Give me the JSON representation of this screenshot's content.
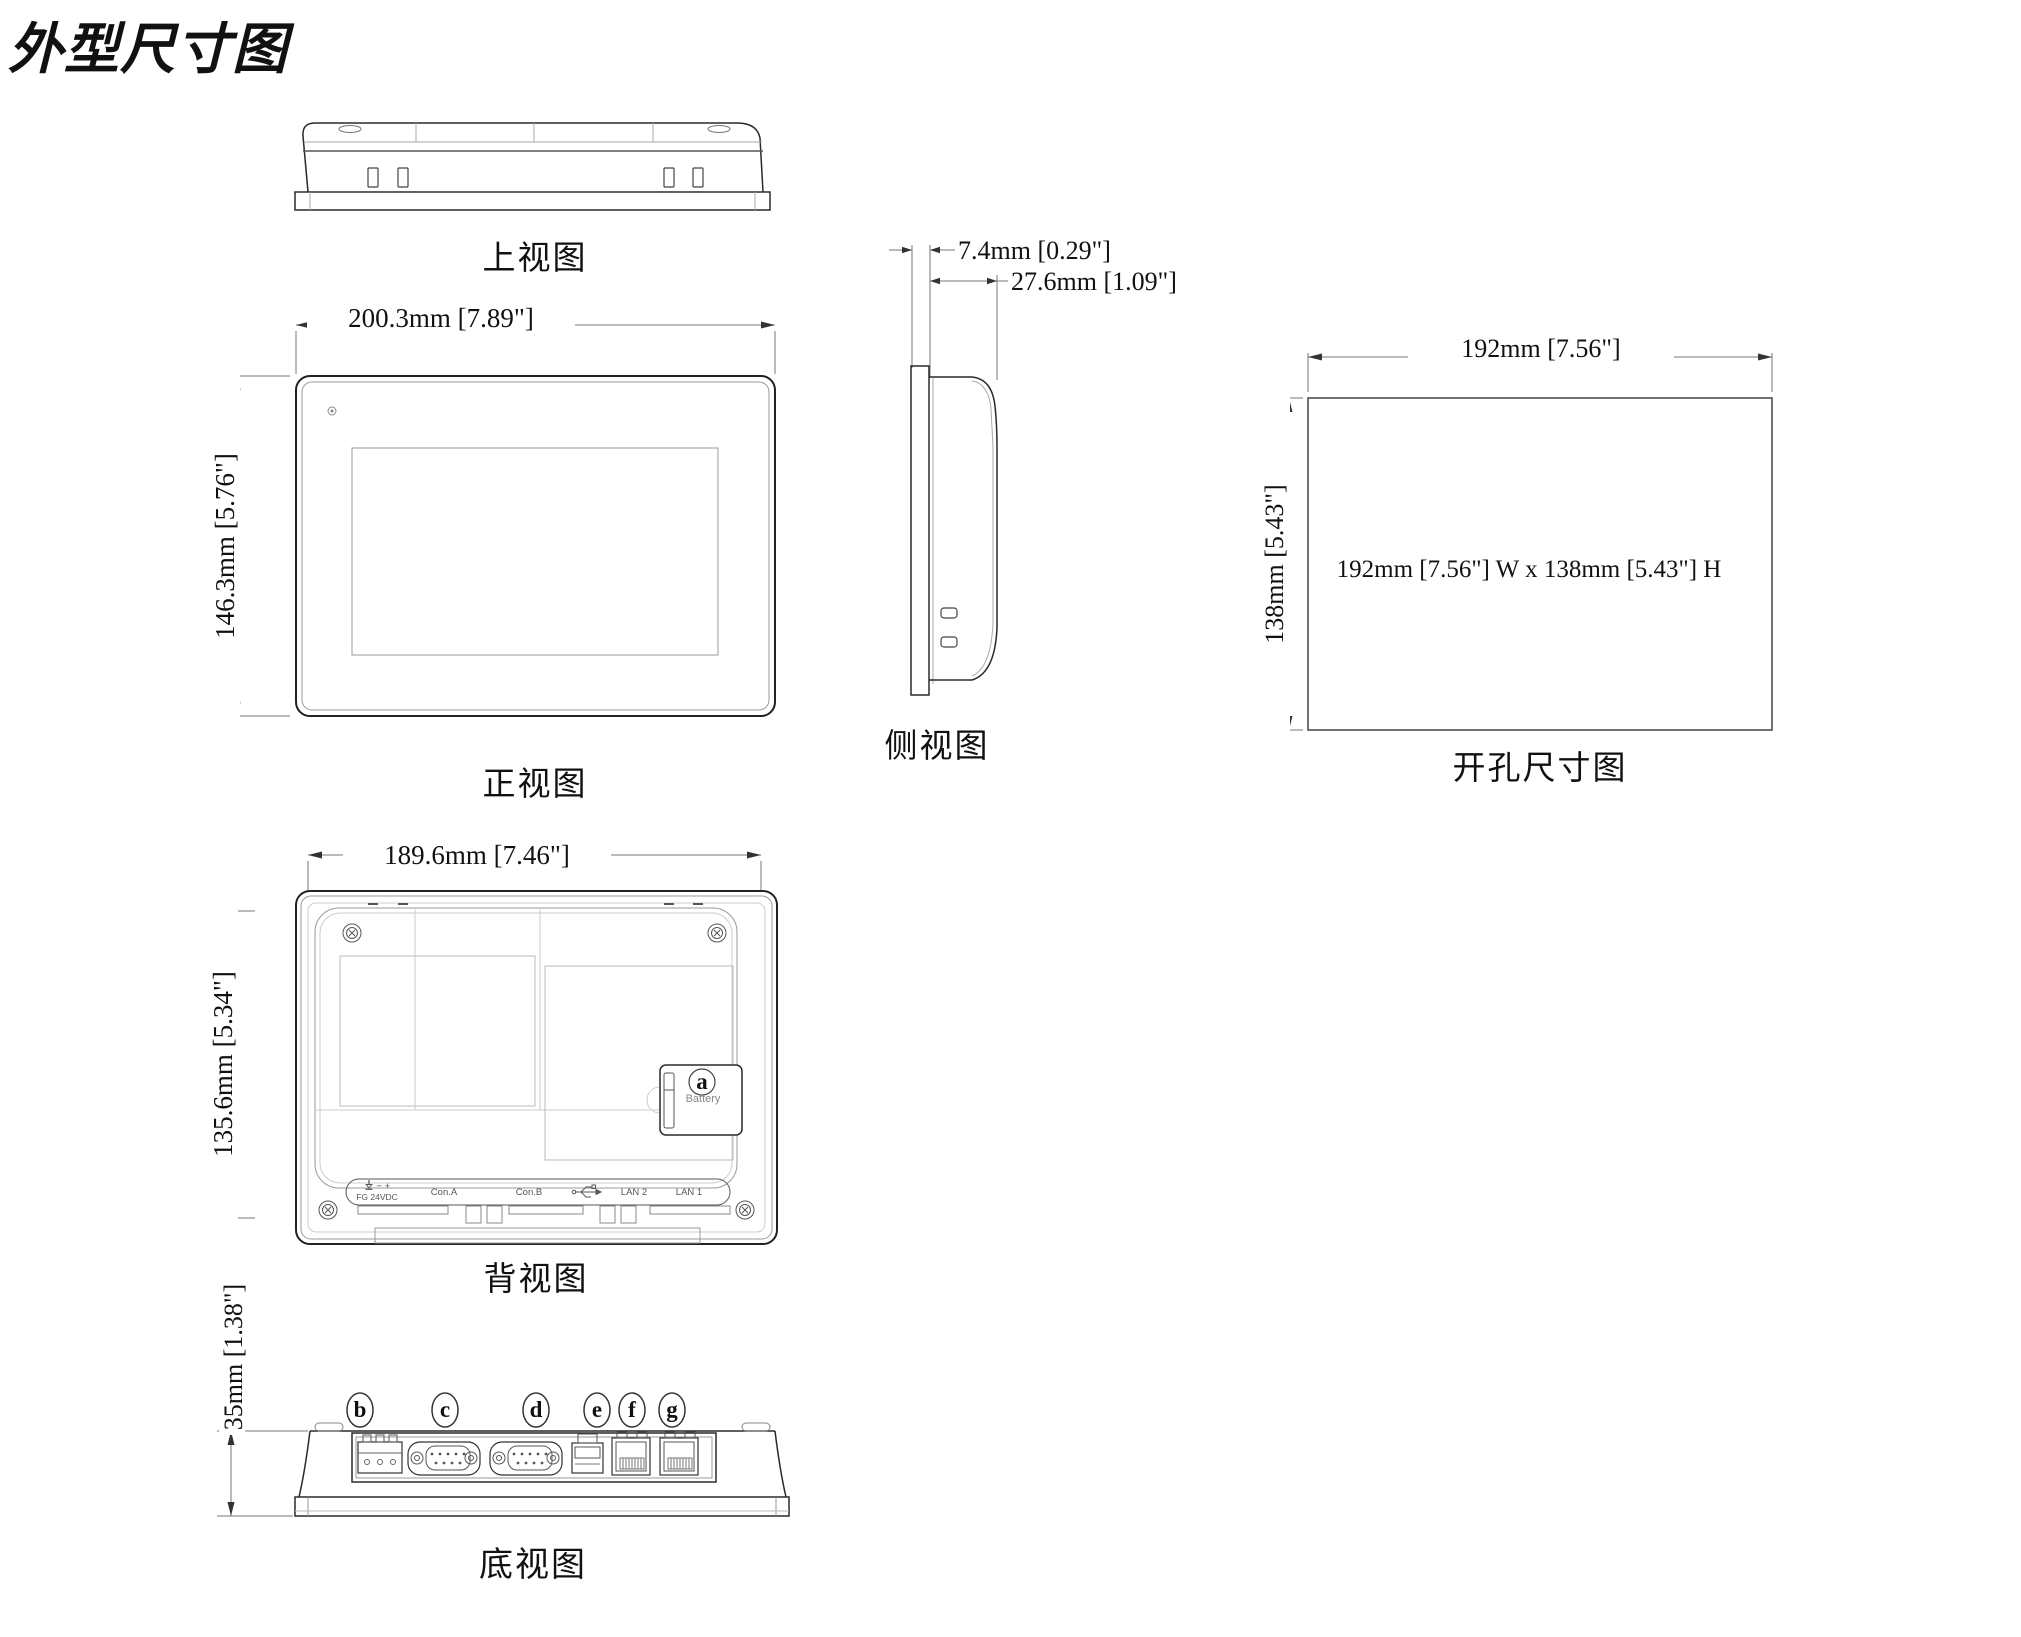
{
  "title": "外型尺寸图",
  "top_view": {
    "label": "上视图"
  },
  "front_view": {
    "label": "正视图",
    "width_dim": "200.3mm [7.89\"]",
    "height_dim": "146.3mm [5.76\"]"
  },
  "side_view": {
    "label": "侧视图",
    "bezel_dim": "7.4mm [0.29\"]",
    "depth_dim": "27.6mm [1.09\"]"
  },
  "cutout_view": {
    "label": "开孔尺寸图",
    "width_dim": "192mm [7.56\"]",
    "height_dim": "138mm [5.43\"]",
    "note": "192mm [7.56\"] W x 138mm [5.43\"] H"
  },
  "rear_view": {
    "label": "背视图",
    "width_dim": "189.6mm [7.46\"]",
    "height_dim": "135.6mm [5.34\"]",
    "battery_callout": "a",
    "battery_label": "Battery",
    "ports": {
      "minus": "−",
      "plus": "+",
      "power": "FG 24VDC",
      "con_a": "Con.A",
      "con_b": "Con.B",
      "lan2": "LAN 2",
      "lan1": "LAN 1"
    }
  },
  "bottom_view": {
    "label": "底视图",
    "height_dim": "35mm [1.38\"]",
    "callouts": [
      "b",
      "c",
      "d",
      "e",
      "f",
      "g"
    ]
  },
  "colors": {
    "outline": "#2a2a2a",
    "light_line": "#9a9a9a",
    "dim_line": "#777777",
    "text": "#111111"
  }
}
